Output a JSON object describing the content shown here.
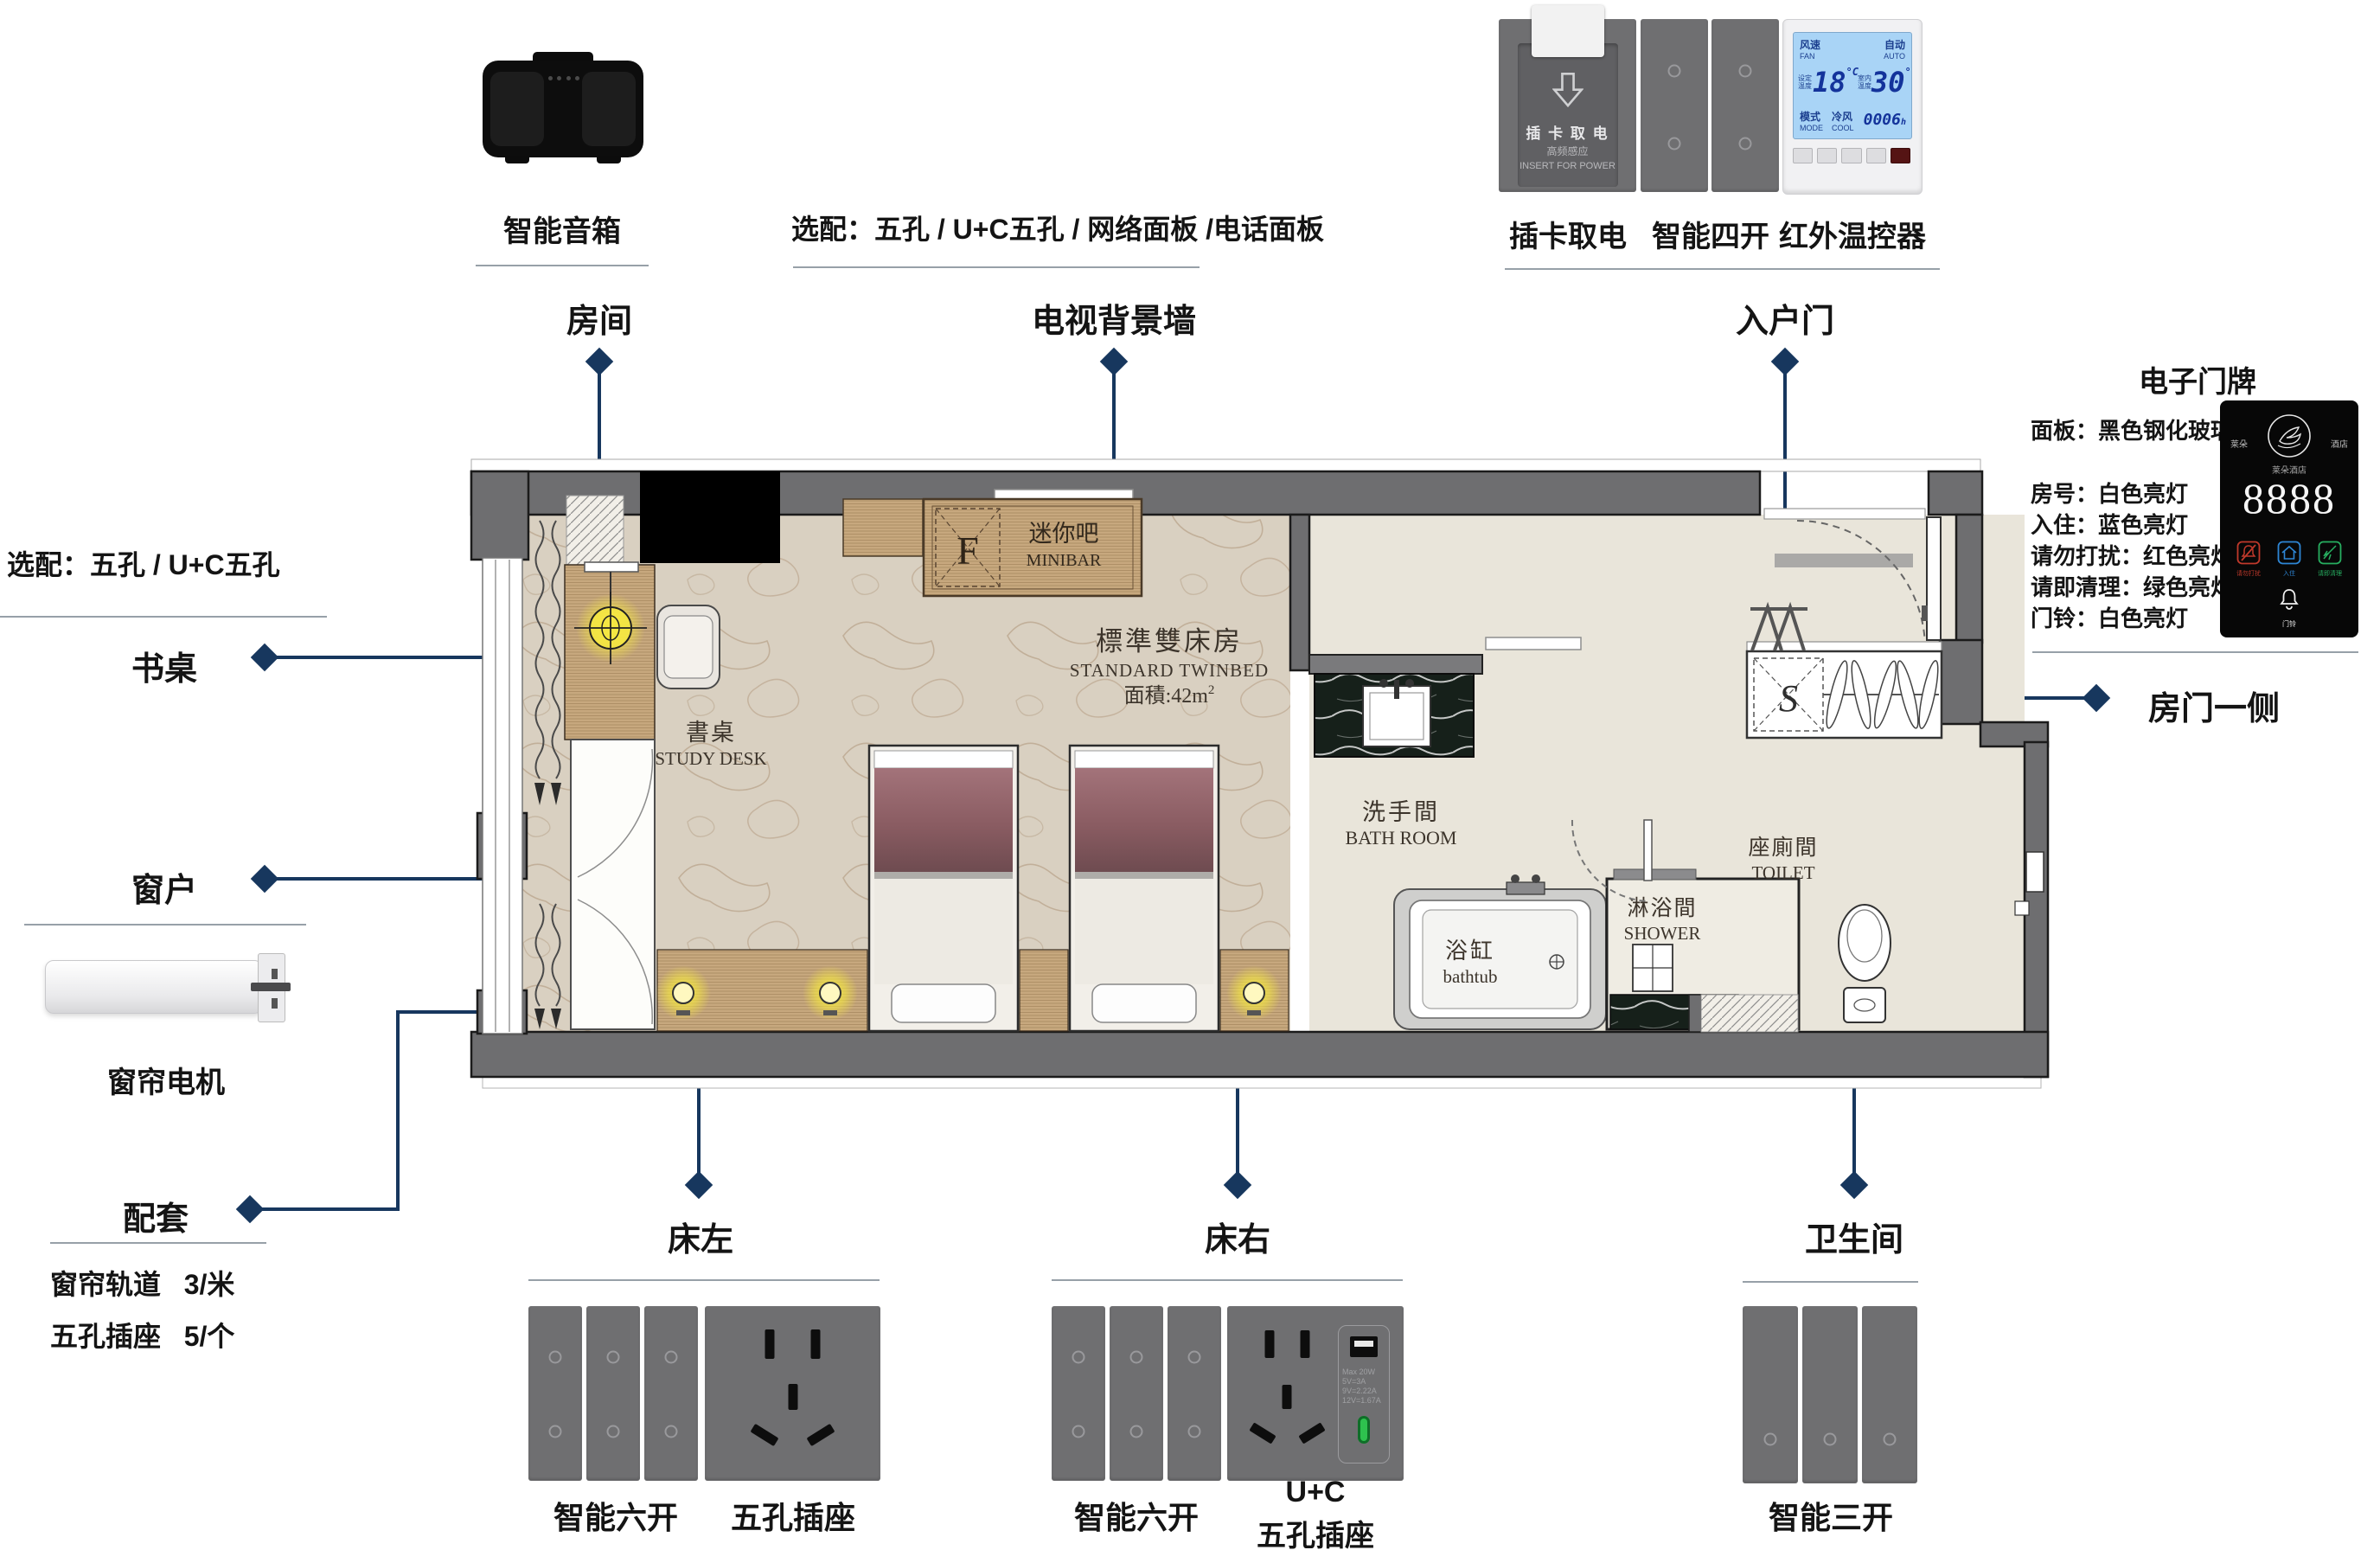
{
  "colors": {
    "accent": "#17375e",
    "wall": "#6e6e70",
    "panel_gray": "#6f6f71"
  },
  "top_left": {
    "label": "智能音箱"
  },
  "top_note": "选配：五孔 /  U+C五孔 / 网络面板 /电话面板",
  "top_right": {
    "card_power": {
      "label": "插卡取电",
      "line1": "插 卡 取 电",
      "line2": "高频感应",
      "line3": "INSERT FOR POWER"
    },
    "four_gang": {
      "label": "智能四开"
    },
    "thermostat": {
      "label": "红外温控器",
      "fan": "风速",
      "fan_en": "FAN",
      "auto": "自动",
      "auto_en": "AUTO",
      "set_label": "设定温度",
      "set_temp": "18",
      "room_label": "室内温度",
      "room_temp": "30",
      "deg": "°C",
      "mode": "模式",
      "mode_en": "MODE",
      "cool": "冷风",
      "cool_en": "COOL",
      "timer": "0006",
      "timer_unit": "h"
    }
  },
  "callouts": {
    "room": "房间",
    "tv_wall": "电视背景墙",
    "entry": "入户门",
    "desk": "书桌",
    "window": "窗户",
    "package": "配套",
    "door_side": "房门一侧",
    "bed_left": "床左",
    "bed_right": "床右",
    "bathroom": "卫生间"
  },
  "left": {
    "note": "选配：五孔 /  U+C五孔",
    "curtain_motor": "窗帘电机",
    "items": [
      {
        "name": "窗帘轨道",
        "qty": "3/米"
      },
      {
        "name": "五孔插座",
        "qty": "5/个"
      }
    ]
  },
  "doorplate": {
    "title": "电子门牌",
    "specs": [
      "面板：黑色钢化玻璃",
      "房号：白色亮灯",
      "入住：蓝色亮灯",
      "请勿打扰：红色亮灯",
      "请即清理：绿色亮灯",
      "门铃：白色亮灯"
    ],
    "brand_left": "莱朵",
    "brand_right": "酒店",
    "brand_small": "莱朵酒店",
    "room_number": "8888",
    "icon_dnd": "请勿打扰",
    "icon_checkin": "入住",
    "icon_clean": "请即清理",
    "bell_label": "门铃"
  },
  "plan": {
    "title_cn": "標準雙床房",
    "title_en": "STANDARD TWINBED",
    "area": "面積:42m",
    "area_sup": "2",
    "desk_cn": "書桌",
    "desk_en": "STUDY DESK",
    "minibar_cn": "迷你吧",
    "minibar_en": "MINIBAR",
    "fridge": "F",
    "bath_cn": "洗手間",
    "bath_en": "BATH ROOM",
    "tub_cn": "浴缸",
    "tub_en": "bathtub",
    "shower_cn": "淋浴間",
    "shower_en": "SHOWER",
    "toilet_cn": "座廁間",
    "toilet_en": "TOILET",
    "wardrobe": "S"
  },
  "bottom": {
    "bed_left": {
      "switch": "智能六开",
      "socket": "五孔插座"
    },
    "bed_right": {
      "switch": "智能六开",
      "socket_l1": "U+C",
      "socket_l2": "五孔插座",
      "usb_spec1": "Max 20W",
      "usb_spec2": "5V=3A",
      "usb_spec3": "9V=2.22A",
      "usb_spec4": "12V=1.67A"
    },
    "bathroom": {
      "switch": "智能三开"
    }
  }
}
